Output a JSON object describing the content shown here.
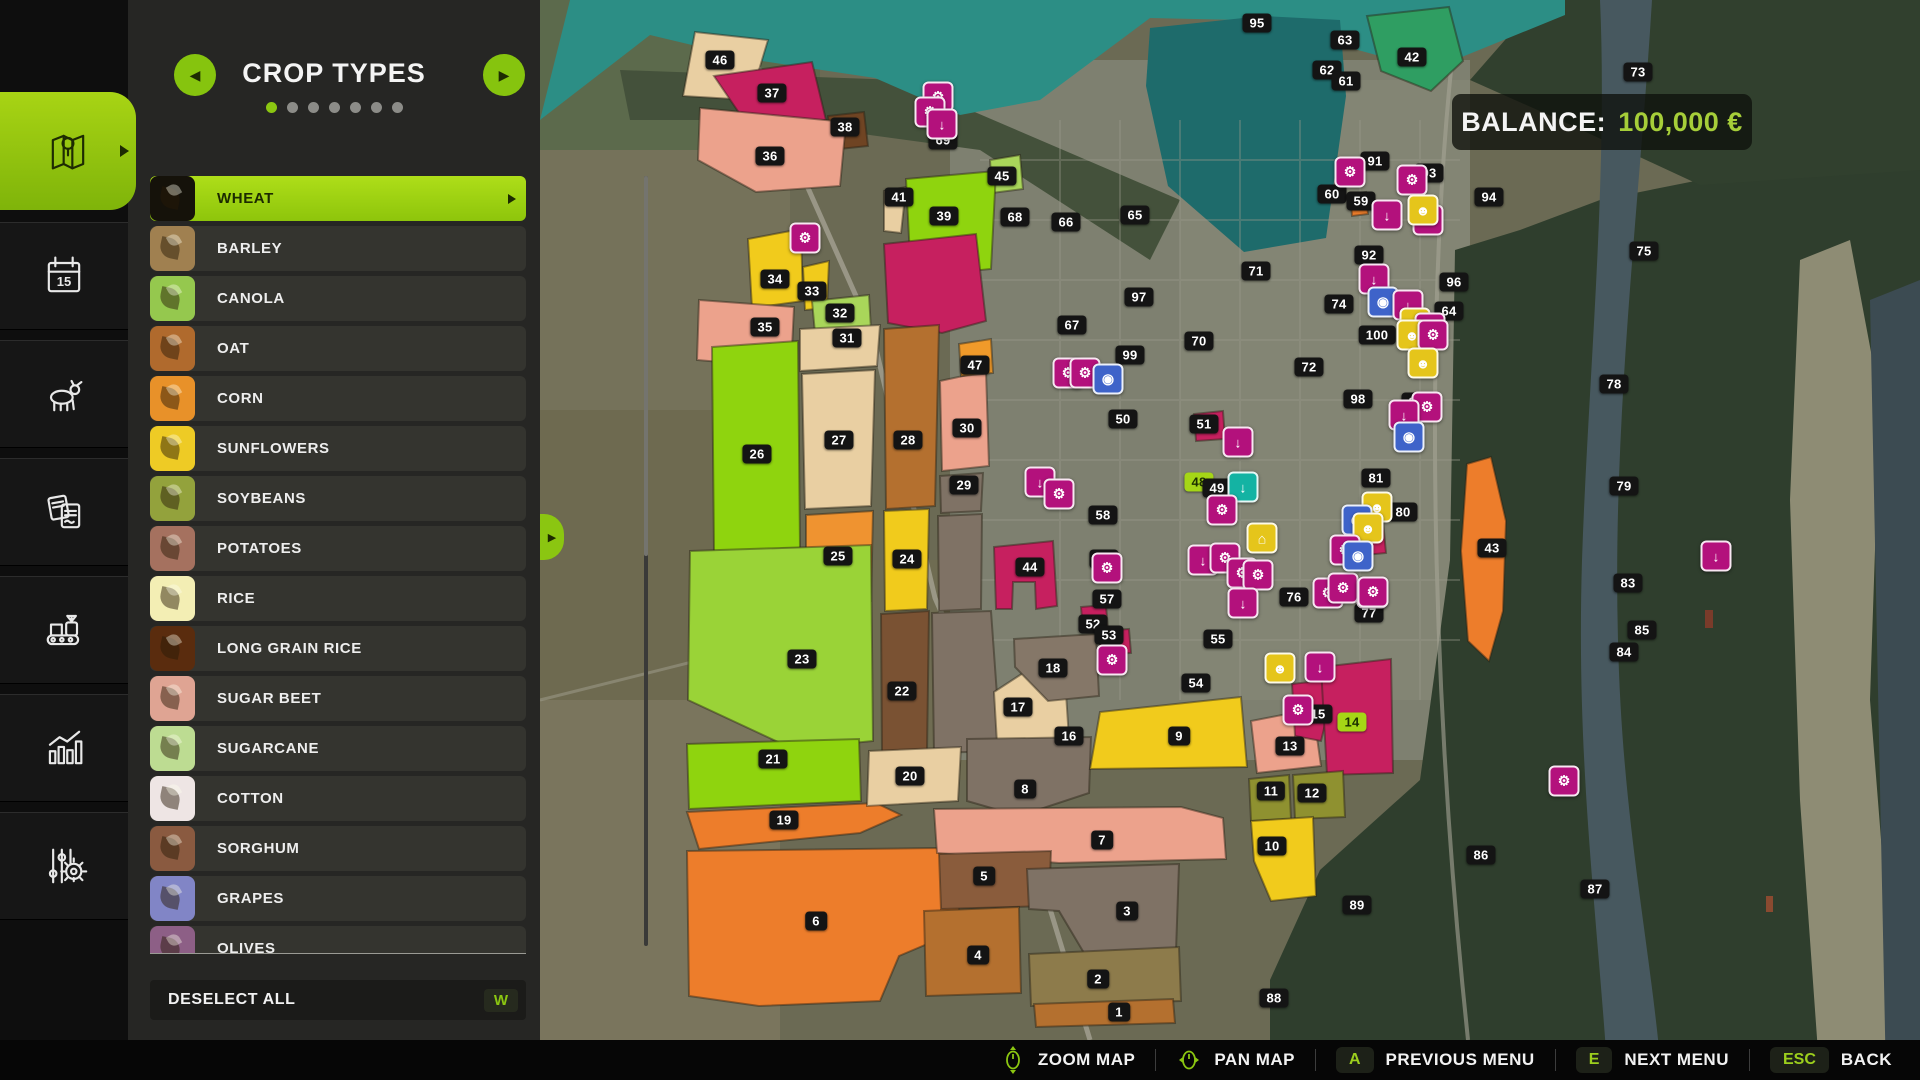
{
  "balance": {
    "label": "BALANCE:",
    "value": "100,000 €"
  },
  "panel": {
    "title": "CROP TYPES",
    "page_dots": {
      "count": 7,
      "active": 0
    },
    "prev_icon": "left-arrow",
    "next_icon": "right-arrow",
    "crops": [
      {
        "label": "WHEAT",
        "tile": "#15120a",
        "selected": true
      },
      {
        "label": "BARLEY",
        "tile": "#a08050",
        "selected": false
      },
      {
        "label": "CANOLA",
        "tile": "#95c84e",
        "selected": false
      },
      {
        "label": "OAT",
        "tile": "#b06a2d",
        "selected": false
      },
      {
        "label": "CORN",
        "tile": "#e89129",
        "selected": false
      },
      {
        "label": "SUNFLOWERS",
        "tile": "#eecb25",
        "selected": false
      },
      {
        "label": "SOYBEANS",
        "tile": "#93a23c",
        "selected": false
      },
      {
        "label": "POTATOES",
        "tile": "#a5715f",
        "selected": false
      },
      {
        "label": "RICE",
        "tile": "#f3eeb4",
        "selected": false
      },
      {
        "label": "LONG GRAIN RICE",
        "tile": "#5a2c0e",
        "selected": false
      },
      {
        "label": "SUGAR BEET",
        "tile": "#dfa493",
        "selected": false
      },
      {
        "label": "SUGARCANE",
        "tile": "#bddc92",
        "selected": false
      },
      {
        "label": "COTTON",
        "tile": "#eee5e4",
        "selected": false
      },
      {
        "label": "SORGHUM",
        "tile": "#8a5a40",
        "selected": false
      },
      {
        "label": "GRAPES",
        "tile": "#8185c6",
        "selected": false
      },
      {
        "label": "OLIVES",
        "tile": "#8d5f86",
        "selected": false
      }
    ],
    "deselect": {
      "label": "DESELECT ALL",
      "key": "W"
    }
  },
  "sidebar": {
    "items": [
      {
        "name": "map",
        "active": true
      },
      {
        "name": "calendar",
        "active": false
      },
      {
        "name": "animals",
        "active": false
      },
      {
        "name": "contracts",
        "active": false
      },
      {
        "name": "production",
        "active": false
      },
      {
        "name": "statistics",
        "active": false
      },
      {
        "name": "settings",
        "active": false
      }
    ]
  },
  "bottom_bar": {
    "items": [
      {
        "icon": "mouse-zoom",
        "label": "ZOOM MAP"
      },
      {
        "icon": "mouse-pan",
        "label": "PAN MAP"
      },
      {
        "key": "A",
        "label": "PREVIOUS MENU"
      },
      {
        "key": "E",
        "label": "NEXT MENU"
      },
      {
        "key": "ESC",
        "label": "BACK"
      }
    ]
  },
  "map": {
    "fields": [
      {
        "n": "46",
        "c": "#e9cfa2",
        "pts": "695,32 768,40 750,100 683,96"
      },
      {
        "n": "37",
        "c": "#c6205f",
        "pts": "714,76 812,62 826,120 748,126"
      },
      {
        "n": "38",
        "c": "#6f4423",
        "pts": "828,116 864,112 868,146 830,150"
      },
      {
        "n": "36",
        "c": "#eca28c",
        "pts": "700,108 846,122 840,186 756,192 698,160"
      },
      {
        "n": "45",
        "c": "#a9d65a",
        "pts": "990,160 1020,155 1023,189 992,193"
      },
      {
        "n": "41",
        "c": "#e9cfa2",
        "pts": "884,191 906,187 901,233 884,231"
      },
      {
        "n": "39",
        "c": "#8fd40e",
        "pts": "906,179 996,171 991,269 911,277"
      },
      {
        "n": "40",
        "c": "#c6205f",
        "pts": "884,244 976,234 986,321 942,333 888,323"
      },
      {
        "n": "34",
        "c": "#f1cb1c",
        "pts": "748,239 801,229 803,301 752,308"
      },
      {
        "n": "33",
        "c": "#f1cb1c",
        "pts": "803,267 829,261 827,308 805,310"
      },
      {
        "n": "32",
        "c": "#a9d65a",
        "pts": "812,301 869,295 871,330 815,333"
      },
      {
        "n": "35",
        "c": "#eca28c",
        "pts": "699,300 794,307 791,368 697,360"
      },
      {
        "n": "31",
        "c": "#e9cfa2",
        "pts": "800,329 880,325 877,366 800,371"
      },
      {
        "n": "27",
        "c": "#e9cfa2",
        "pts": "802,374 875,370 871,506 805,509"
      },
      {
        "n": "28",
        "c": "#b4702f",
        "pts": "884,329 939,325 935,506 886,509"
      },
      {
        "n": "30",
        "c": "#eca28c",
        "pts": "940,381 986,371 989,466 942,471"
      },
      {
        "n": "29",
        "c": "#7f7265",
        "pts": "940,476 983,473 981,511 941,513"
      },
      {
        "n": "",
        "c": "#7f7265",
        "pts": "938,516 982,514 981,609 939,611"
      },
      {
        "n": "25",
        "c": "#ef9330",
        "pts": "806,515 873,511 871,601 806,605"
      },
      {
        "n": "24",
        "c": "#f1cb1c",
        "pts": "884,511 929,509 927,609 885,611"
      },
      {
        "n": "44",
        "c": "#c6205f",
        "pts": "994,547 1053,541 1057,606 1036,609 1035,582 1013,582 1012,609 996,609"
      },
      {
        "n": "26",
        "c": "#8fd40e",
        "pts": "712,347 798,341 800,548 714,552"
      },
      {
        "n": "23",
        "c": "#9ad337",
        "pts": "690,551 871,545 873,741 793,749 688,700"
      },
      {
        "n": "22",
        "c": "#7a5233",
        "pts": "881,614 929,611 927,753 882,756"
      },
      {
        "n": "",
        "c": "#7f7265",
        "pts": "932,613 991,611 1001,751 934,753"
      },
      {
        "n": "17",
        "c": "#e9cfa2",
        "pts": "994,692 1063,647 1069,739 997,743"
      },
      {
        "n": "18",
        "c": "#857768",
        "pts": "1014,639 1096,634 1099,696 1048,701 1015,667"
      },
      {
        "n": "21",
        "c": "#8fd40e",
        "pts": "687,744 859,739 861,801 689,809"
      },
      {
        "n": "19",
        "c": "#ed7d2b",
        "pts": "687,812 876,803 901,815 860,833 699,849"
      },
      {
        "n": "6",
        "c": "#ed7d2b",
        "pts": "687,851 936,848 961,863 958,931 899,956 880,1001 759,1006 689,996"
      },
      {
        "n": "20",
        "c": "#e9cfa2",
        "pts": "869,751 961,747 958,801 867,806"
      },
      {
        "n": "8",
        "c": "#7f7265",
        "pts": "967,739 1091,737 1089,793 1019,816 967,801"
      },
      {
        "n": "7",
        "c": "#eca28c",
        "pts": "934,809 1181,807 1223,818 1226,859 1059,863 937,853"
      },
      {
        "n": "5",
        "c": "#8a5c3c",
        "pts": "939,854 1051,851 1049,906 941,909"
      },
      {
        "n": "4",
        "c": "#b4702f",
        "pts": "924,911 1019,907 1021,993 926,996"
      },
      {
        "n": "3",
        "c": "#7f7265",
        "pts": "1027,869 1179,864 1176,951 1084,953 1059,911 1029,909"
      },
      {
        "n": "2",
        "c": "#8d7b4b",
        "pts": "1029,954 1179,947 1181,1001 1031,1006"
      },
      {
        "n": "1",
        "c": "#b4702f",
        "pts": "1034,1004 1173,999 1175,1023 1036,1027"
      },
      {
        "n": "9",
        "c": "#f1cb1c",
        "pts": "1100,712 1241,697 1247,767 1090,769"
      },
      {
        "n": "13",
        "c": "#eca28c",
        "pts": "1251,721 1313,709 1321,766 1257,773"
      },
      {
        "n": "15",
        "c": "#c6205f",
        "pts": "1292,684 1336,679 1321,741 1295,736"
      },
      {
        "n": "14",
        "c": "#c6205f",
        "pts": "1321,667 1391,659 1393,773 1327,775"
      },
      {
        "n": "11",
        "c": "#8f9130",
        "pts": "1249,779 1289,775 1291,819 1251,821"
      },
      {
        "n": "12",
        "c": "#8f9130",
        "pts": "1293,775 1343,771 1345,817 1295,819"
      },
      {
        "n": "10",
        "c": "#f1cb1c",
        "pts": "1251,821 1313,817 1316,896 1271,901 1254,861"
      },
      {
        "n": "43",
        "c": "#ed7d2b",
        "pts": "1467,464 1491,457 1506,521 1503,611 1489,661 1468,641 1461,551"
      },
      {
        "n": "42",
        "c": "#2f9e62",
        "pts": "1367,16 1449,7 1463,61 1431,91 1381,71"
      },
      {
        "n": "51",
        "c": "#c6205f",
        "pts": "1194,414 1223,411 1225,439 1196,441"
      },
      {
        "n": "58",
        "c": "#c6205f",
        "pts": "1351,524 1383,521 1386,553 1354,556"
      },
      {
        "n": "52",
        "c": "#c6205f",
        "pts": "1081,607 1106,605 1108,630 1083,632"
      },
      {
        "n": "53",
        "c": "#c6205f",
        "pts": "1099,631 1129,629 1131,653 1101,655"
      },
      {
        "n": "47",
        "c": "#f09a2a",
        "pts": "959,344 991,339 993,373 961,376"
      },
      {
        "n": "",
        "c": "#ed7d2b",
        "pts": "1350,194 1366,192 1368,214 1352,216"
      }
    ],
    "labels": [
      {
        "n": "46",
        "x": 720,
        "y": 60
      },
      {
        "n": "37",
        "x": 772,
        "y": 93
      },
      {
        "n": "38",
        "x": 845,
        "y": 127
      },
      {
        "n": "36",
        "x": 770,
        "y": 156
      },
      {
        "n": "69",
        "x": 943,
        "y": 140
      },
      {
        "n": "45",
        "x": 1002,
        "y": 176
      },
      {
        "n": "41",
        "x": 899,
        "y": 197
      },
      {
        "n": "39",
        "x": 944,
        "y": 216
      },
      {
        "n": "68",
        "x": 1015,
        "y": 217
      },
      {
        "n": "66",
        "x": 1066,
        "y": 222
      },
      {
        "n": "65",
        "x": 1135,
        "y": 215
      },
      {
        "n": "95",
        "x": 1257,
        "y": 23
      },
      {
        "n": "63",
        "x": 1345,
        "y": 40
      },
      {
        "n": "42",
        "x": 1412,
        "y": 57
      },
      {
        "n": "62",
        "x": 1327,
        "y": 70
      },
      {
        "n": "61",
        "x": 1346,
        "y": 81
      },
      {
        "n": "73",
        "x": 1638,
        "y": 72
      },
      {
        "n": "91",
        "x": 1375,
        "y": 161
      },
      {
        "n": "93",
        "x": 1429,
        "y": 173
      },
      {
        "n": "60",
        "x": 1332,
        "y": 194
      },
      {
        "n": "59",
        "x": 1361,
        "y": 201
      },
      {
        "n": "94",
        "x": 1489,
        "y": 197
      },
      {
        "n": "92",
        "x": 1369,
        "y": 255
      },
      {
        "n": "71",
        "x": 1256,
        "y": 271
      },
      {
        "n": "96",
        "x": 1454,
        "y": 282
      },
      {
        "n": "74",
        "x": 1339,
        "y": 304
      },
      {
        "n": "64",
        "x": 1449,
        "y": 311
      },
      {
        "n": "100",
        "x": 1377,
        "y": 335
      },
      {
        "n": "70",
        "x": 1199,
        "y": 341
      },
      {
        "n": "67",
        "x": 1072,
        "y": 325
      },
      {
        "n": "99",
        "x": 1130,
        "y": 355
      },
      {
        "n": "97",
        "x": 1139,
        "y": 297
      },
      {
        "n": "34",
        "x": 775,
        "y": 279
      },
      {
        "n": "33",
        "x": 812,
        "y": 291
      },
      {
        "n": "32",
        "x": 840,
        "y": 313
      },
      {
        "n": "35",
        "x": 765,
        "y": 327
      },
      {
        "n": "31",
        "x": 847,
        "y": 338
      },
      {
        "n": "47",
        "x": 975,
        "y": 365
      },
      {
        "n": "72",
        "x": 1309,
        "y": 367
      },
      {
        "n": "98",
        "x": 1358,
        "y": 399
      },
      {
        "n": "82",
        "x": 1416,
        "y": 402
      },
      {
        "n": "26",
        "x": 757,
        "y": 454
      },
      {
        "n": "27",
        "x": 839,
        "y": 440
      },
      {
        "n": "28",
        "x": 908,
        "y": 440
      },
      {
        "n": "30",
        "x": 967,
        "y": 428
      },
      {
        "n": "29",
        "x": 964,
        "y": 485
      },
      {
        "n": "50",
        "x": 1123,
        "y": 419
      },
      {
        "n": "51",
        "x": 1204,
        "y": 424
      },
      {
        "n": "81",
        "x": 1376,
        "y": 478
      },
      {
        "n": "80",
        "x": 1403,
        "y": 512
      },
      {
        "n": "25",
        "x": 838,
        "y": 556
      },
      {
        "n": "24",
        "x": 907,
        "y": 559
      },
      {
        "n": "44",
        "x": 1030,
        "y": 567
      },
      {
        "n": "56",
        "x": 1104,
        "y": 559
      },
      {
        "n": "58",
        "x": 1103,
        "y": 515
      },
      {
        "n": "57",
        "x": 1107,
        "y": 599
      },
      {
        "n": "52",
        "x": 1093,
        "y": 624
      },
      {
        "n": "53",
        "x": 1109,
        "y": 635
      },
      {
        "n": "23",
        "x": 802,
        "y": 659
      },
      {
        "n": "22",
        "x": 902,
        "y": 691
      },
      {
        "n": "18",
        "x": 1053,
        "y": 668
      },
      {
        "n": "17",
        "x": 1018,
        "y": 707
      },
      {
        "n": "16",
        "x": 1069,
        "y": 736
      },
      {
        "n": "55",
        "x": 1218,
        "y": 639
      },
      {
        "n": "54",
        "x": 1196,
        "y": 683
      },
      {
        "n": "76",
        "x": 1294,
        "y": 597
      },
      {
        "n": "77",
        "x": 1369,
        "y": 613
      },
      {
        "n": "15",
        "x": 1318,
        "y": 714
      },
      {
        "n": "14",
        "x": 1352,
        "y": 722,
        "g": true
      },
      {
        "n": "13",
        "x": 1290,
        "y": 746
      },
      {
        "n": "11",
        "x": 1271,
        "y": 791
      },
      {
        "n": "12",
        "x": 1312,
        "y": 793
      },
      {
        "n": "10",
        "x": 1272,
        "y": 846
      },
      {
        "n": "9",
        "x": 1179,
        "y": 736
      },
      {
        "n": "86",
        "x": 1481,
        "y": 855
      },
      {
        "n": "89",
        "x": 1357,
        "y": 905
      },
      {
        "n": "78",
        "x": 1614,
        "y": 384
      },
      {
        "n": "79",
        "x": 1624,
        "y": 486
      },
      {
        "n": "83",
        "x": 1628,
        "y": 583
      },
      {
        "n": "84",
        "x": 1624,
        "y": 652
      },
      {
        "n": "43",
        "x": 1492,
        "y": 548
      },
      {
        "n": "48",
        "x": 1199,
        "y": 482,
        "g": true
      },
      {
        "n": "49",
        "x": 1217,
        "y": 488
      },
      {
        "n": "21",
        "x": 773,
        "y": 759
      },
      {
        "n": "20",
        "x": 910,
        "y": 776
      },
      {
        "n": "8",
        "x": 1025,
        "y": 789
      },
      {
        "n": "19",
        "x": 784,
        "y": 820
      },
      {
        "n": "7",
        "x": 1102,
        "y": 840
      },
      {
        "n": "5",
        "x": 984,
        "y": 876
      },
      {
        "n": "6",
        "x": 816,
        "y": 921
      },
      {
        "n": "3",
        "x": 1127,
        "y": 911
      },
      {
        "n": "4",
        "x": 978,
        "y": 955
      },
      {
        "n": "2",
        "x": 1098,
        "y": 979
      },
      {
        "n": "1",
        "x": 1119,
        "y": 1012
      },
      {
        "n": "88",
        "x": 1274,
        "y": 998
      },
      {
        "n": "87",
        "x": 1595,
        "y": 889
      },
      {
        "n": "85",
        "x": 1642,
        "y": 630
      },
      {
        "n": "75",
        "x": 1644,
        "y": 251
      }
    ],
    "icons": [
      {
        "t": "p",
        "x": 938,
        "y": 97
      },
      {
        "t": "p",
        "x": 930,
        "y": 112
      },
      {
        "t": "s",
        "x": 942,
        "y": 124
      },
      {
        "t": "p",
        "x": 805,
        "y": 238
      },
      {
        "t": "p",
        "x": 1350,
        "y": 172
      },
      {
        "t": "p",
        "x": 1412,
        "y": 180
      },
      {
        "t": "s",
        "x": 1387,
        "y": 215
      },
      {
        "t": "p",
        "x": 1428,
        "y": 220
      },
      {
        "t": "y",
        "x": 1423,
        "y": 210
      },
      {
        "t": "s",
        "x": 1374,
        "y": 279
      },
      {
        "t": "b",
        "x": 1383,
        "y": 302
      },
      {
        "t": "s",
        "x": 1408,
        "y": 305
      },
      {
        "t": "y",
        "x": 1415,
        "y": 323
      },
      {
        "t": "s",
        "x": 1430,
        "y": 328
      },
      {
        "t": "p",
        "x": 1068,
        "y": 373
      },
      {
        "t": "p",
        "x": 1085,
        "y": 373
      },
      {
        "t": "b",
        "x": 1108,
        "y": 379
      },
      {
        "t": "s",
        "x": 1040,
        "y": 482
      },
      {
        "t": "p",
        "x": 1059,
        "y": 494
      },
      {
        "t": "p",
        "x": 1107,
        "y": 568
      },
      {
        "t": "p",
        "x": 1112,
        "y": 660
      },
      {
        "t": "s",
        "x": 1238,
        "y": 442
      },
      {
        "t": "t",
        "x": 1243,
        "y": 487
      },
      {
        "t": "p",
        "x": 1222,
        "y": 510
      },
      {
        "t": "h",
        "x": 1262,
        "y": 538
      },
      {
        "t": "s",
        "x": 1203,
        "y": 560
      },
      {
        "t": "p",
        "x": 1225,
        "y": 558
      },
      {
        "t": "p",
        "x": 1242,
        "y": 573
      },
      {
        "t": "p",
        "x": 1258,
        "y": 575
      },
      {
        "t": "s",
        "x": 1243,
        "y": 603
      },
      {
        "t": "p",
        "x": 1328,
        "y": 593
      },
      {
        "t": "p",
        "x": 1343,
        "y": 588
      },
      {
        "t": "p",
        "x": 1372,
        "y": 593
      },
      {
        "t": "s",
        "x": 1320,
        "y": 667
      },
      {
        "t": "y",
        "x": 1280,
        "y": 668
      },
      {
        "t": "p",
        "x": 1298,
        "y": 710
      },
      {
        "t": "y",
        "x": 1412,
        "y": 335
      },
      {
        "t": "p",
        "x": 1433,
        "y": 335
      },
      {
        "t": "y",
        "x": 1423,
        "y": 363
      },
      {
        "t": "p",
        "x": 1427,
        "y": 407
      },
      {
        "t": "s",
        "x": 1404,
        "y": 415
      },
      {
        "t": "b",
        "x": 1409,
        "y": 437
      },
      {
        "t": "y",
        "x": 1377,
        "y": 507
      },
      {
        "t": "b",
        "x": 1357,
        "y": 520
      },
      {
        "t": "y",
        "x": 1368,
        "y": 528
      },
      {
        "t": "p",
        "x": 1345,
        "y": 550
      },
      {
        "t": "b",
        "x": 1358,
        "y": 556
      },
      {
        "t": "p",
        "x": 1373,
        "y": 592
      },
      {
        "t": "p",
        "x": 1564,
        "y": 781
      },
      {
        "t": "s",
        "x": 1716,
        "y": 556
      }
    ]
  }
}
